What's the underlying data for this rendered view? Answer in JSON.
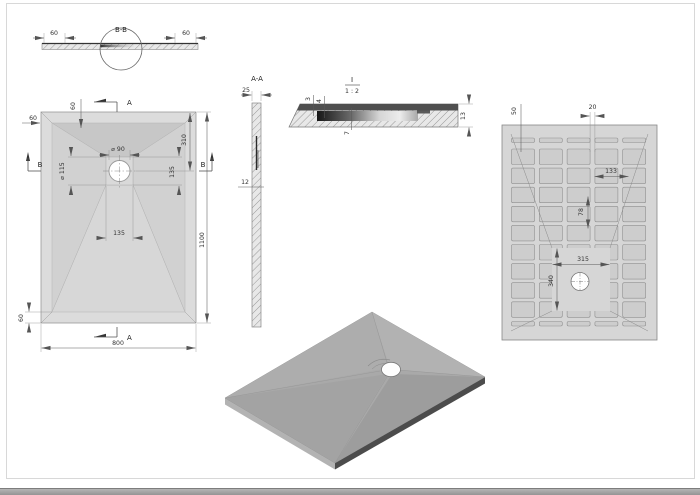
{
  "labels": {
    "section_bb": "B-B",
    "section_aa": "A-A",
    "detail_name": "I",
    "detail_scale": "1 : 2",
    "arrow_a": "A",
    "arrow_b": "B"
  },
  "section_bb": {
    "dim_left": "60",
    "dim_right": "60"
  },
  "top_view": {
    "width": "800",
    "length": "1100",
    "rim_top_left": "60",
    "rim_top": "60",
    "rim_bottom_left": "60",
    "drain_offset": "310",
    "drain_dia": "⌀ 90",
    "flange_dia": "⌀ 115",
    "off_135_v": "135",
    "off_135_h": "135"
  },
  "section_aa": {
    "thickness": "25",
    "dim_mid": "12"
  },
  "detail": {
    "d3": "3",
    "d4": "4",
    "d7": "7",
    "d13": "13"
  },
  "bottom_view": {
    "d50": "50",
    "d20": "20",
    "d133": "133",
    "d78": "78",
    "d315": "315",
    "d340": "340"
  },
  "colors": {
    "tray_rim": "#dcdcdc",
    "slope_dark": "#c7c7c7",
    "slope_light": "#d7d7d7",
    "iso_top": "#a9a9a9",
    "iso_edge_dark": "#4c4c4c",
    "line": "#5a5a5a"
  }
}
